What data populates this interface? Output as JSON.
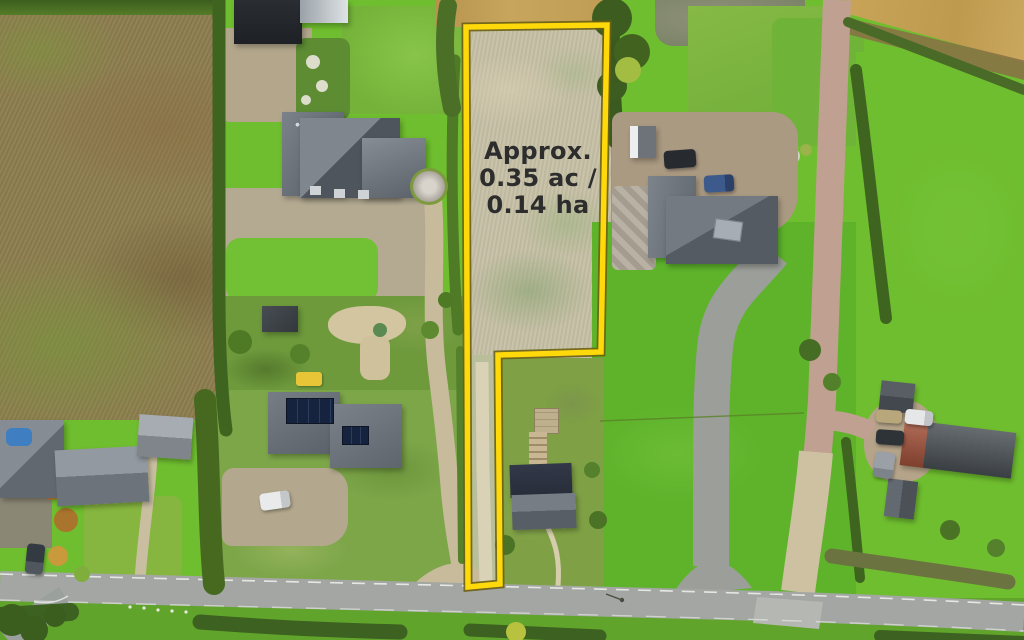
{
  "overlay": {
    "area_label": {
      "line1": "Approx.",
      "line2": "0.35 ac /",
      "line3": "0.14 ha"
    }
  },
  "palette": {
    "grass-bright": "#6fbe2f",
    "grass-field": "#5eb32b",
    "grass-medium": "#7ab13e",
    "grass-rough": "#7da649",
    "field-brown": "#8e7e50",
    "field-golden": "#c59f56",
    "plot-pale": "#c6c0a6",
    "hedge-dark": "#3f641f",
    "road-gray": "#a3a6a2",
    "track-pink": "#c0a090",
    "gravel-tan": "#c7bb9b",
    "roof-slate": "#646b72",
    "roof-dark": "#2c323e",
    "barn-dark": "#22262a",
    "roof-red": "#a2513a",
    "solar-blue": "#16233f",
    "boundary-yellow": "#ffd90a",
    "boundary-edge": "#6b6012",
    "label-color": "#2d2d2d",
    "road-line-white": "#eceee9"
  },
  "scene": {
    "description": "Aerial drone photograph of a rural roadside building plot outlined in yellow, surrounded by houses, gardens, fields, hedgerows, driveways and a country road.",
    "features": [
      "highlighted building plot with yellow boundary",
      "ploughed brown field",
      "golden stubble field",
      "slate-roofed country houses",
      "dark farm barn",
      "house with rooftop solar panels",
      "gravel courtyards and driveways",
      "pink farm track",
      "green pasture fields",
      "hedgerows and garden shrubs",
      "parked cars",
      "country road with dashed white edge lines",
      "road junction"
    ]
  }
}
